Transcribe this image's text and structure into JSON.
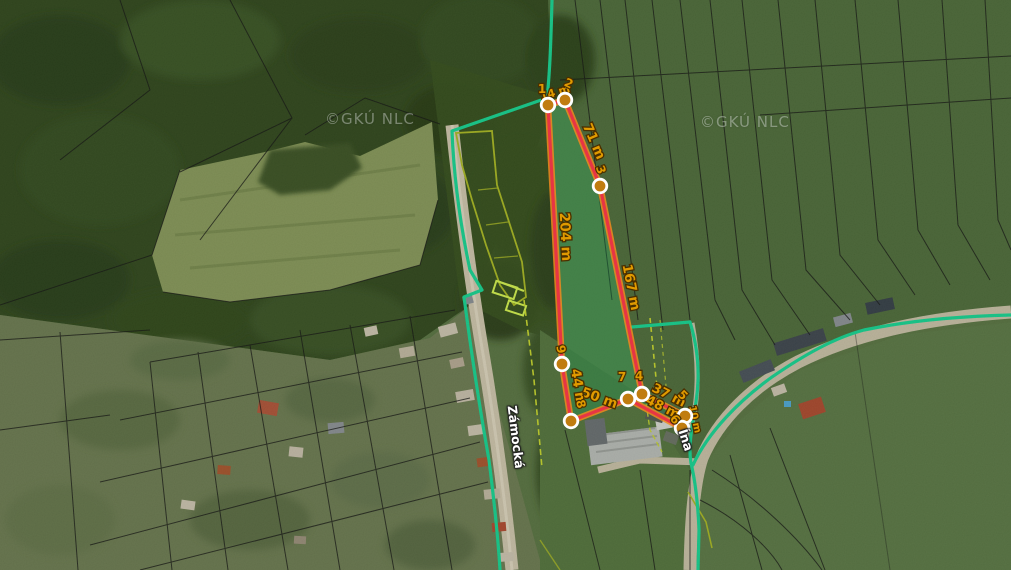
{
  "map": {
    "watermarks": [
      {
        "text": "©GKÚ NLC",
        "x": 325,
        "y": 110
      },
      {
        "text": "©GKÚ NLC",
        "x": 700,
        "y": 113
      }
    ],
    "street_labels": [
      {
        "name": "Zámocká",
        "x": 516,
        "y": 437,
        "rotation": 83
      },
      {
        "name": "Ína",
        "x": 686,
        "y": 440,
        "rotation": 72
      }
    ],
    "measurement": {
      "unit": "m",
      "colors": {
        "outline": "#e73544",
        "outline_glow": "#f08a1e",
        "area_fill": "rgba(20,160,90,0.30)",
        "marker_fill": "#c07c10",
        "marker_ring": "#ffffff",
        "label_fill": "#e09a00",
        "label_outline": "#4a2f00"
      },
      "vertices": [
        {
          "n": "1",
          "x": 548,
          "y": 105,
          "lx": 542,
          "ly": 93,
          "rot": 0
        },
        {
          "n": "2",
          "x": 565,
          "y": 100,
          "lx": 567,
          "ly": 87,
          "rot": 25
        },
        {
          "n": "3",
          "x": 600,
          "y": 186,
          "lx": 597,
          "ly": 171,
          "rot": 70
        },
        {
          "n": "4",
          "x": 642,
          "y": 394,
          "lx": 639,
          "ly": 380,
          "rot": 0
        },
        {
          "n": "5",
          "x": 685,
          "y": 416,
          "lx": 680,
          "ly": 398,
          "rot": 45
        },
        {
          "n": "6",
          "x": 682,
          "y": 428,
          "lx": 672,
          "ly": 422,
          "rot": 50
        },
        {
          "n": "7",
          "x": 628,
          "y": 399,
          "lx": 622,
          "ly": 381,
          "rot": 0
        },
        {
          "n": "8",
          "x": 571,
          "y": 421,
          "lx": 577,
          "ly": 405,
          "rot": 75
        },
        {
          "n": "9",
          "x": 562,
          "y": 364,
          "lx": 557,
          "ly": 350,
          "rot": 80
        }
      ],
      "segments": [
        {
          "from": "1",
          "to": "2",
          "length_m": 14,
          "label": "14 m",
          "x": 556,
          "y": 96,
          "rot": -16,
          "size": 11
        },
        {
          "from": "2",
          "to": "3",
          "length_m": 71,
          "label": "71 m",
          "x": 590,
          "y": 143,
          "rot": 67,
          "size": 13.5
        },
        {
          "from": "3",
          "to": "4",
          "length_m": 167,
          "label": "167 m",
          "x": 627,
          "y": 288,
          "rot": 79,
          "size": 13.5
        },
        {
          "from": "4",
          "to": "5",
          "length_m": 37,
          "label": "37 m",
          "x": 667,
          "y": 399,
          "rot": 27,
          "size": 13
        },
        {
          "from": "5",
          "to": "6",
          "length_m": 10,
          "label": "10 m",
          "x": 692,
          "y": 420,
          "rot": 78,
          "size": 10
        },
        {
          "from": "6",
          "to": "7",
          "length_m": 48,
          "label": "48 m",
          "x": 661,
          "y": 411,
          "rot": 27,
          "size": 13
        },
        {
          "from": "7",
          "to": "8",
          "length_m": 50,
          "label": "50 m",
          "x": 598,
          "y": 402,
          "rot": 20,
          "size": 13.5
        },
        {
          "from": "8",
          "to": "9",
          "length_m": 44,
          "label": "44 m",
          "x": 574,
          "y": 388,
          "rot": 81,
          "size": 13.5
        },
        {
          "from": "9",
          "to": "1",
          "length_m": 204,
          "label": "204 m",
          "x": 561,
          "y": 237,
          "rot": 87,
          "size": 14
        }
      ]
    },
    "parcel_layer_colors": {
      "teal_boundary": "#17d494",
      "yellow_boundary": "#bfcf2a",
      "highlight_lime": "#d3f150",
      "black_cadastral": "#151515"
    }
  }
}
